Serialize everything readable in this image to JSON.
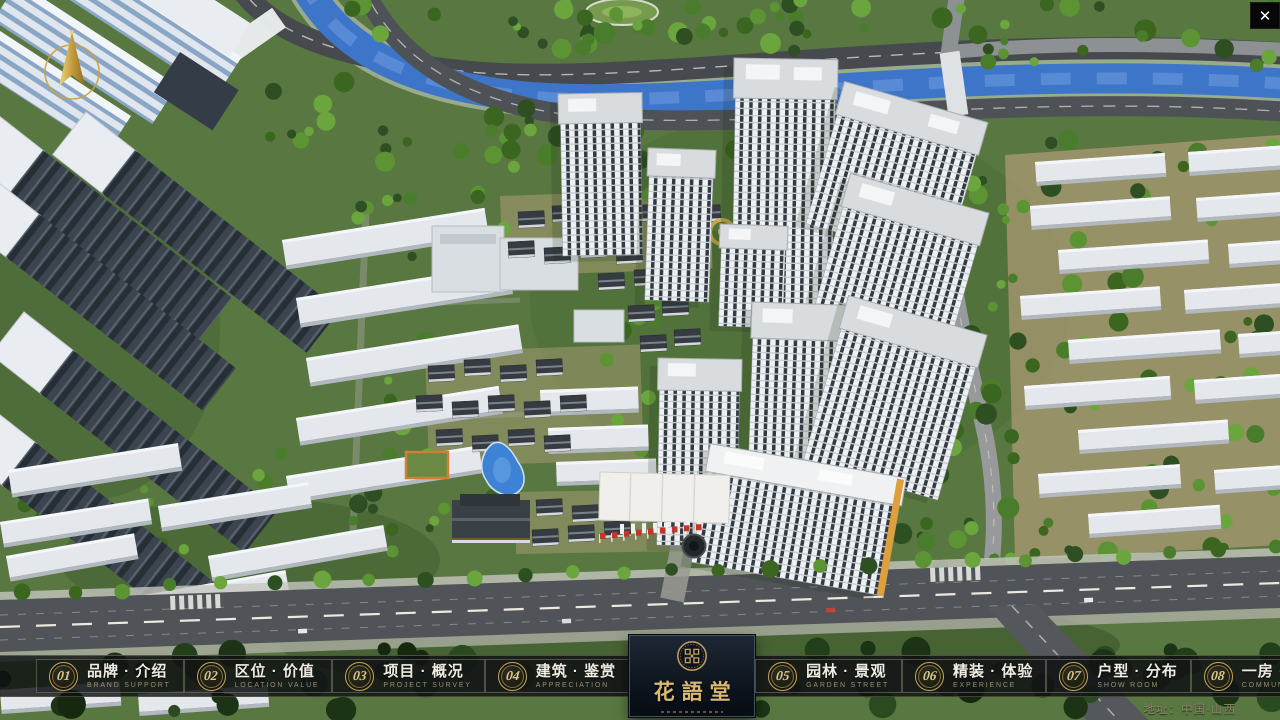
{
  "icons": {
    "close": "✕"
  },
  "logo": {
    "title": "花語堂"
  },
  "menu": {
    "items": [
      {
        "num": "01",
        "label": "品牌 · 介绍",
        "sub": "BRAND SUPPORT"
      },
      {
        "num": "02",
        "label": "区位 · 价值",
        "sub": "LOCATION VALUE"
      },
      {
        "num": "03",
        "label": "项目 · 概况",
        "sub": "PROJECT SURVEY"
      },
      {
        "num": "04",
        "label": "建筑 · 鉴赏",
        "sub": "APPRECIATION"
      },
      {
        "num": "05",
        "label": "园林 · 景观",
        "sub": "GARDEN STREET"
      },
      {
        "num": "06",
        "label": "精装 · 体验",
        "sub": "EXPERIENCE"
      },
      {
        "num": "07",
        "label": "户型 · 分布",
        "sub": "SHOW ROOM"
      },
      {
        "num": "08",
        "label": "一房 · 一景",
        "sub": "COMMUNITY"
      }
    ]
  },
  "footer": {
    "address": "地址：中国·山西"
  },
  "colors": {
    "accent_gold": "#c8a45c",
    "navbar_bg": "#0e1113",
    "logo_panel_bg": "#111a26",
    "river_blue": "#3d76c9",
    "grass_green": "#587741"
  }
}
